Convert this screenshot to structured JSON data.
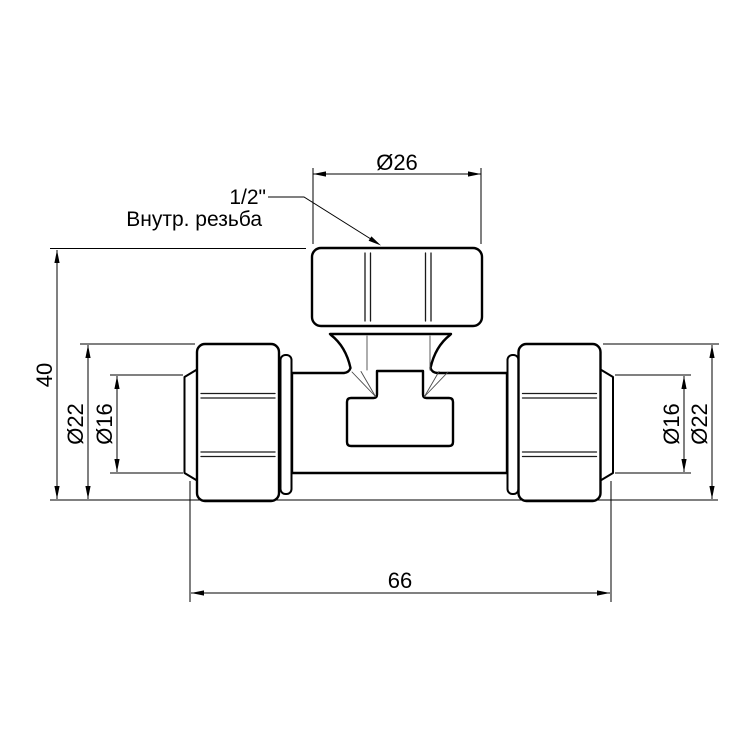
{
  "drawing": {
    "background_color": "#ffffff",
    "line_color": "#000000",
    "callout": {
      "size": "1/2\"",
      "label": "Внутр. резьба"
    },
    "dimensions": {
      "branch_thread_od": "Ø26",
      "height": "40",
      "left_nut_od": "Ø22",
      "left_pipe_od": "Ø16",
      "length": "66",
      "right_pipe_od": "Ø16",
      "right_nut_od": "Ø22"
    }
  }
}
